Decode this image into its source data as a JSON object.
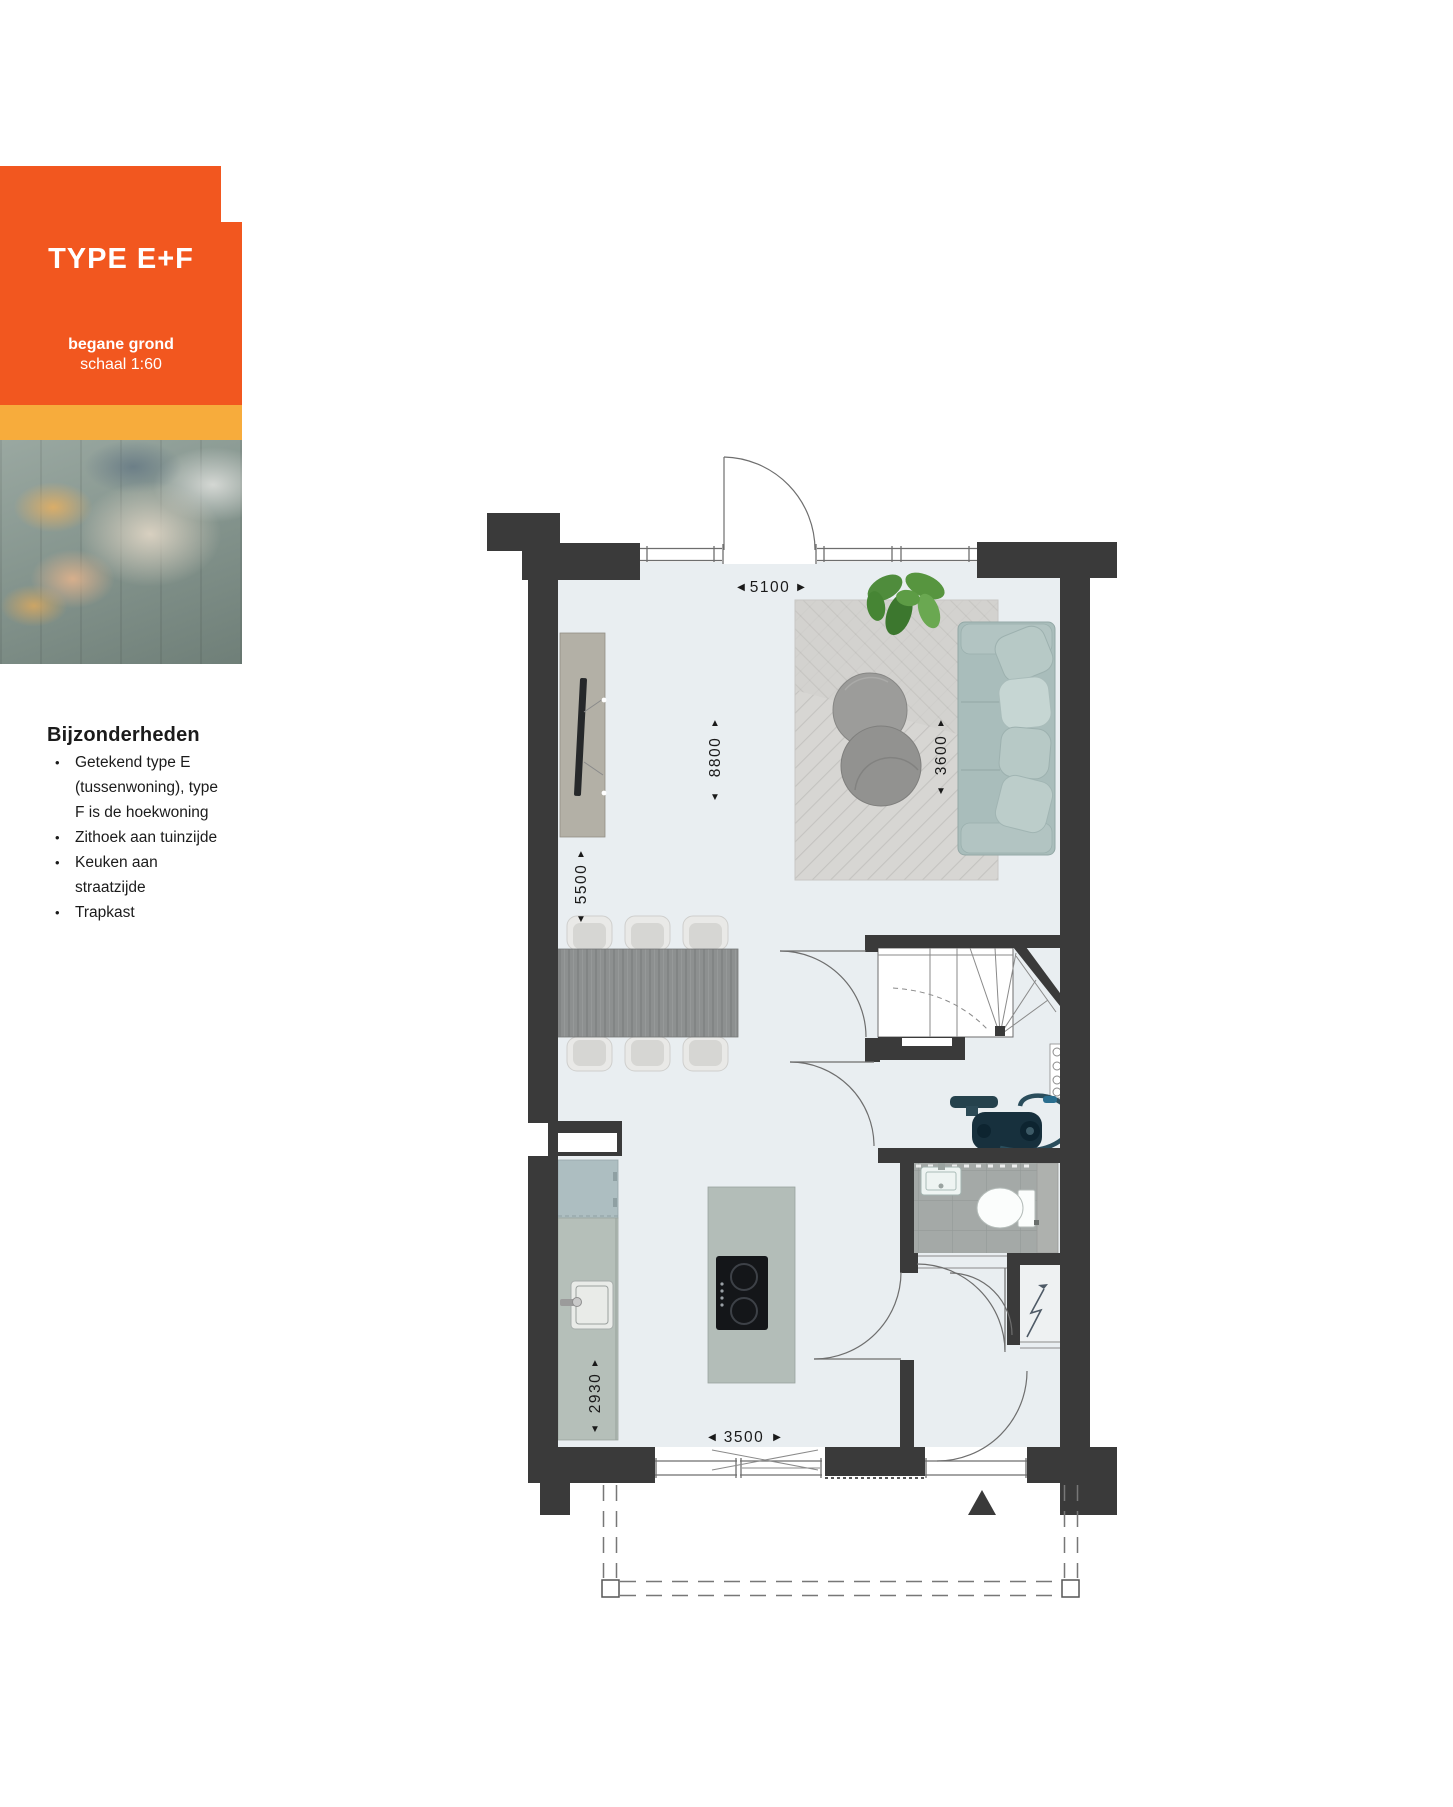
{
  "card": {
    "type_label": "TYPE E+F",
    "floor_label": "begane grond",
    "scale_label": "schaal 1:60"
  },
  "details": {
    "heading": "Bijzonderheden",
    "items": [
      "Getekend type E (tussenwoning), type F is de hoekwoning",
      "Zithoek aan tuinzijde",
      "Keuken aan straatzijde",
      "Trapkast"
    ]
  },
  "plan": {
    "dimensions": {
      "top_width": "5100",
      "room_depth": "8800",
      "living_width": "3600",
      "side_depth": "5500",
      "kitchen_depth": "2930",
      "bottom_width": "3500"
    },
    "arrows": {
      "left": "◀",
      "right": "▶",
      "up": "▲",
      "down": "▼"
    }
  },
  "colors": {
    "accent_orange": "#F2571F",
    "accent_yellow": "#F7AC3C",
    "wall": "#3A3A3A",
    "floor": "#E9EEF1",
    "counter": "#B5BFB9",
    "sofa": "#A9BDBB"
  }
}
